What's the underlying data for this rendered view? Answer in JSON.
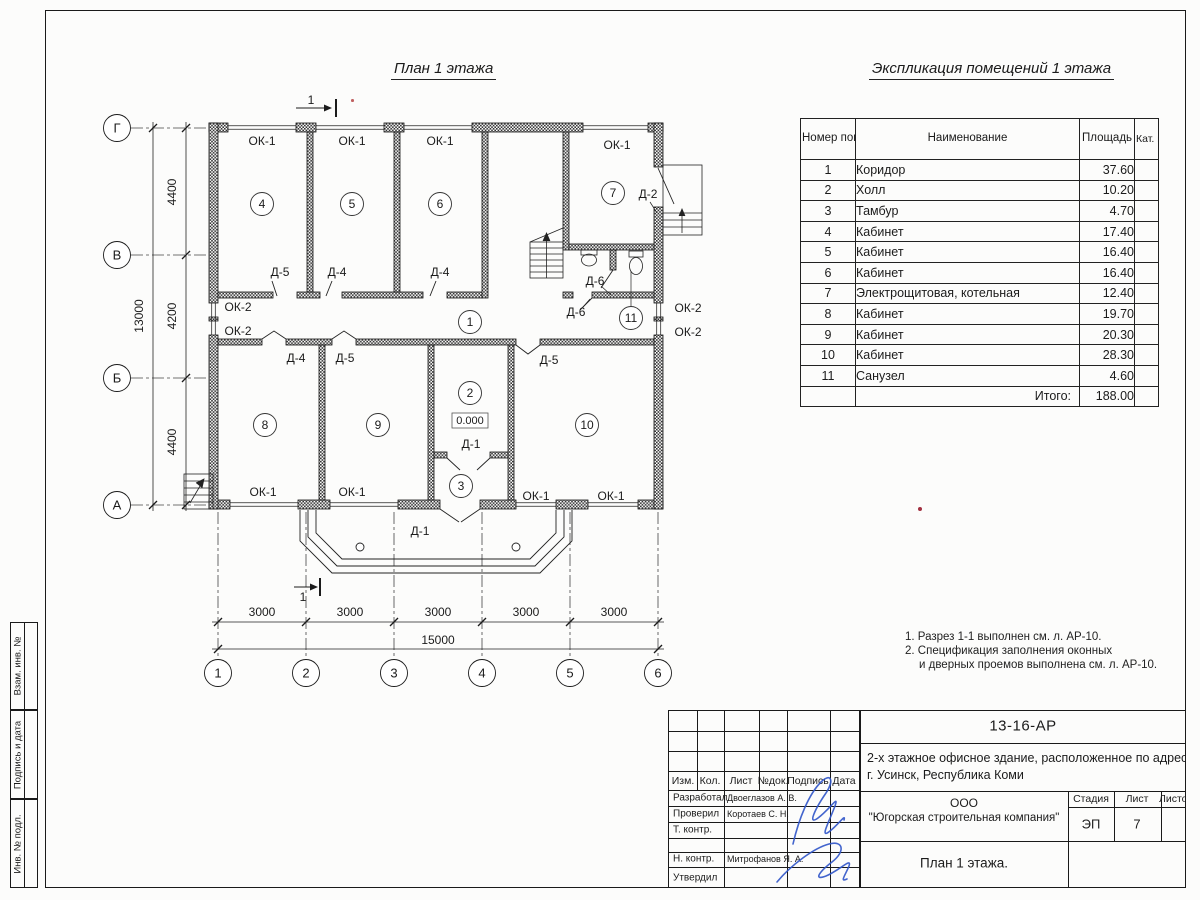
{
  "plan": {
    "title": "План 1 этажа",
    "section_mark": "1",
    "level_mark": "0.000",
    "labels": {
      "ok1": "ОК-1",
      "ok2": "ОК-2",
      "d1": "Д-1",
      "d2": "Д-2",
      "d4": "Д-4",
      "d5": "Д-5",
      "d6": "Д-6"
    },
    "room_markers": [
      "1",
      "2",
      "3",
      "4",
      "5",
      "6",
      "7",
      "8",
      "9",
      "10",
      "11"
    ],
    "axes": {
      "rows": [
        "Г",
        "В",
        "Б",
        "А"
      ],
      "cols": [
        "1",
        "2",
        "3",
        "4",
        "5",
        "6"
      ]
    },
    "dimensions": {
      "bottom": [
        "3000",
        "3000",
        "3000",
        "3000",
        "3000"
      ],
      "bottom_total": "15000",
      "left": [
        "4400",
        "4200",
        "4400"
      ],
      "left_total": "13000"
    }
  },
  "schedule": {
    "title": "Экспликация помещений 1 этажа",
    "headers": {
      "number": "Номер помещ.",
      "name": "Наименование",
      "area": "Площадь",
      "cat": "Кат. пом."
    },
    "rows": [
      {
        "number": "1",
        "name": "Коридор",
        "area": "37.60"
      },
      {
        "number": "2",
        "name": "Холл",
        "area": "10.20"
      },
      {
        "number": "3",
        "name": "Тамбур",
        "area": "4.70"
      },
      {
        "number": "4",
        "name": "Кабинет",
        "area": "17.40"
      },
      {
        "number": "5",
        "name": "Кабинет",
        "area": "16.40"
      },
      {
        "number": "6",
        "name": "Кабинет",
        "area": "16.40"
      },
      {
        "number": "7",
        "name": "Электрощитовая, котельная",
        "area": "12.40"
      },
      {
        "number": "8",
        "name": "Кабинет",
        "area": "19.70"
      },
      {
        "number": "9",
        "name": "Кабинет",
        "area": "20.30"
      },
      {
        "number": "10",
        "name": "Кабинет",
        "area": "28.30"
      },
      {
        "number": "11",
        "name": "Санузел",
        "area": "4.60"
      }
    ],
    "total_label": "Итого:",
    "total_area": "188.00"
  },
  "notes": {
    "line1": "1. Разрез 1-1 выполнен см. л. АР-10.",
    "line2": "2. Спецификация заполнения оконных",
    "line3": "и дверных проемов выполнена см. л. АР-10."
  },
  "margin_stamps": [
    "Взам. инв. №",
    "Подпись и дата",
    "Инв. № подл."
  ],
  "title_block": {
    "doc_number": "13-16-АР",
    "project_line1": "2-х этажное офисное здание, расположенное по адресу:",
    "project_line2": "г. Усинск, Республика Коми",
    "company_line1": "ООО",
    "company_line2": "\"Югорская строительная компания\"",
    "sheet_title": "План 1 этажа.",
    "cols": {
      "izm": "Изм.",
      "kol": "Кол.",
      "list": "Лист",
      "ndok": "№док.",
      "podpis": "Подпись",
      "data": "Дата"
    },
    "roles": [
      {
        "role": "Разработал",
        "name": "Двоеглазов А. В."
      },
      {
        "role": "Проверил",
        "name": "Коротаев С. Н."
      },
      {
        "role": "Т. контр.",
        "name": ""
      },
      {
        "role": "",
        "name": ""
      },
      {
        "role": "Н. контр.",
        "name": "Митрофанов Я. А."
      },
      {
        "role": "Утвердил",
        "name": ""
      }
    ],
    "stage_header": "Стадия",
    "sheet_header": "Лист",
    "sheets_header": "Листов",
    "stage": "ЭП",
    "sheet_number": "7",
    "sheets_total": ""
  },
  "colors": {
    "line": "#1b1b1b",
    "signature": "#2f55c9",
    "artifact": "#b03030"
  }
}
